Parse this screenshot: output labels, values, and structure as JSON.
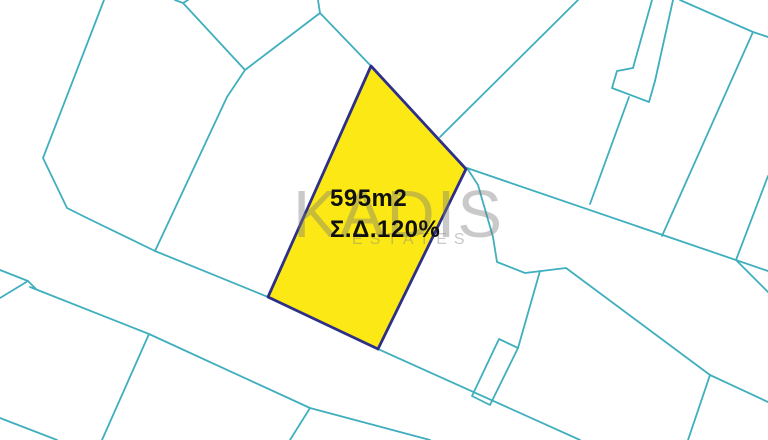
{
  "map": {
    "background": "#ffffff",
    "boundary_color": "#3FAFBE",
    "boundary_width": 1.8,
    "parcel": {
      "fill": "#FCE815",
      "stroke": "#2D2F88",
      "stroke_width": 2.8,
      "points": [
        [
          371,
          66
        ],
        [
          466,
          169
        ],
        [
          378,
          349
        ],
        [
          268,
          297
        ]
      ],
      "label_area": "595m2",
      "label_coefficient": "Σ.Δ.120%"
    },
    "watermark": {
      "brand": "KADIS",
      "subtitle": "ESTATES"
    },
    "lines": [
      {
        "points": [
          [
            104,
            0
          ],
          [
            43,
            158
          ],
          [
            67,
            208
          ],
          [
            87,
            218
          ],
          [
            155,
            251
          ]
        ]
      },
      {
        "points": [
          [
            175,
            0
          ],
          [
            183,
            3
          ],
          [
            188,
            0
          ]
        ]
      },
      {
        "points": [
          [
            183,
            3
          ],
          [
            245,
            70
          ]
        ]
      },
      {
        "points": [
          [
            245,
            70
          ],
          [
            227,
            97
          ],
          [
            155,
            251
          ]
        ]
      },
      {
        "points": [
          [
            245,
            70
          ],
          [
            320,
            13
          ]
        ]
      },
      {
        "points": [
          [
            318,
            0
          ],
          [
            320,
            13
          ]
        ]
      },
      {
        "points": [
          [
            320,
            13
          ],
          [
            371,
            66
          ]
        ]
      },
      {
        "points": [
          [
            578,
            0
          ],
          [
            440,
            137
          ]
        ]
      },
      {
        "points": [
          [
            467,
            168
          ],
          [
            768,
            271
          ]
        ]
      },
      {
        "points": [
          [
            467,
            168
          ],
          [
            478,
            185
          ],
          [
            493,
            237
          ],
          [
            497,
            262
          ],
          [
            525,
            273
          ],
          [
            566,
            268
          ],
          [
            710,
            375
          ],
          [
            768,
            402
          ]
        ]
      },
      {
        "points": [
          [
            710,
            375
          ],
          [
            688,
            440
          ]
        ]
      },
      {
        "points": [
          [
            155,
            251
          ],
          [
            268,
            297
          ]
        ]
      },
      {
        "points": [
          [
            378,
            349
          ],
          [
            580,
            440
          ]
        ]
      },
      {
        "points": [
          [
            30,
            287
          ],
          [
            149,
            334
          ],
          [
            310,
            408
          ],
          [
            430,
            440
          ]
        ]
      },
      {
        "points": [
          [
            149,
            334
          ],
          [
            102,
            440
          ]
        ]
      },
      {
        "points": [
          [
            310,
            408
          ],
          [
            290,
            440
          ]
        ]
      },
      {
        "points": [
          [
            0,
            270
          ],
          [
            28,
            281
          ],
          [
            0,
            298
          ]
        ]
      },
      {
        "points": [
          [
            28,
            281
          ],
          [
            36,
            289
          ]
        ]
      },
      {
        "points": [
          [
            0,
            418
          ],
          [
            57,
            440
          ]
        ]
      },
      {
        "points": [
          [
            499,
            339
          ],
          [
            518,
            348
          ],
          [
            490,
            405
          ],
          [
            472,
            396
          ],
          [
            499,
            339
          ]
        ]
      },
      {
        "points": [
          [
            540,
            271
          ],
          [
            518,
            348
          ]
        ]
      },
      {
        "points": [
          [
            652,
            0
          ],
          [
            633,
            68
          ]
        ]
      },
      {
        "points": [
          [
            673,
            0
          ],
          [
            655,
            81
          ]
        ]
      },
      {
        "points": [
          [
            633,
            68
          ],
          [
            617,
            71
          ],
          [
            612,
            88
          ],
          [
            649,
            102
          ],
          [
            655,
            81
          ]
        ]
      },
      {
        "points": [
          [
            629,
            97
          ],
          [
            590,
            204
          ]
        ]
      },
      {
        "points": [
          [
            680,
            0
          ],
          [
            753,
            32
          ],
          [
            768,
            37
          ]
        ]
      },
      {
        "points": [
          [
            753,
            32
          ],
          [
            662,
            236
          ]
        ]
      },
      {
        "points": [
          [
            768,
            176
          ],
          [
            736,
            260
          ]
        ]
      },
      {
        "points": [
          [
            736,
            260
          ],
          [
            768,
            292
          ]
        ]
      }
    ]
  }
}
